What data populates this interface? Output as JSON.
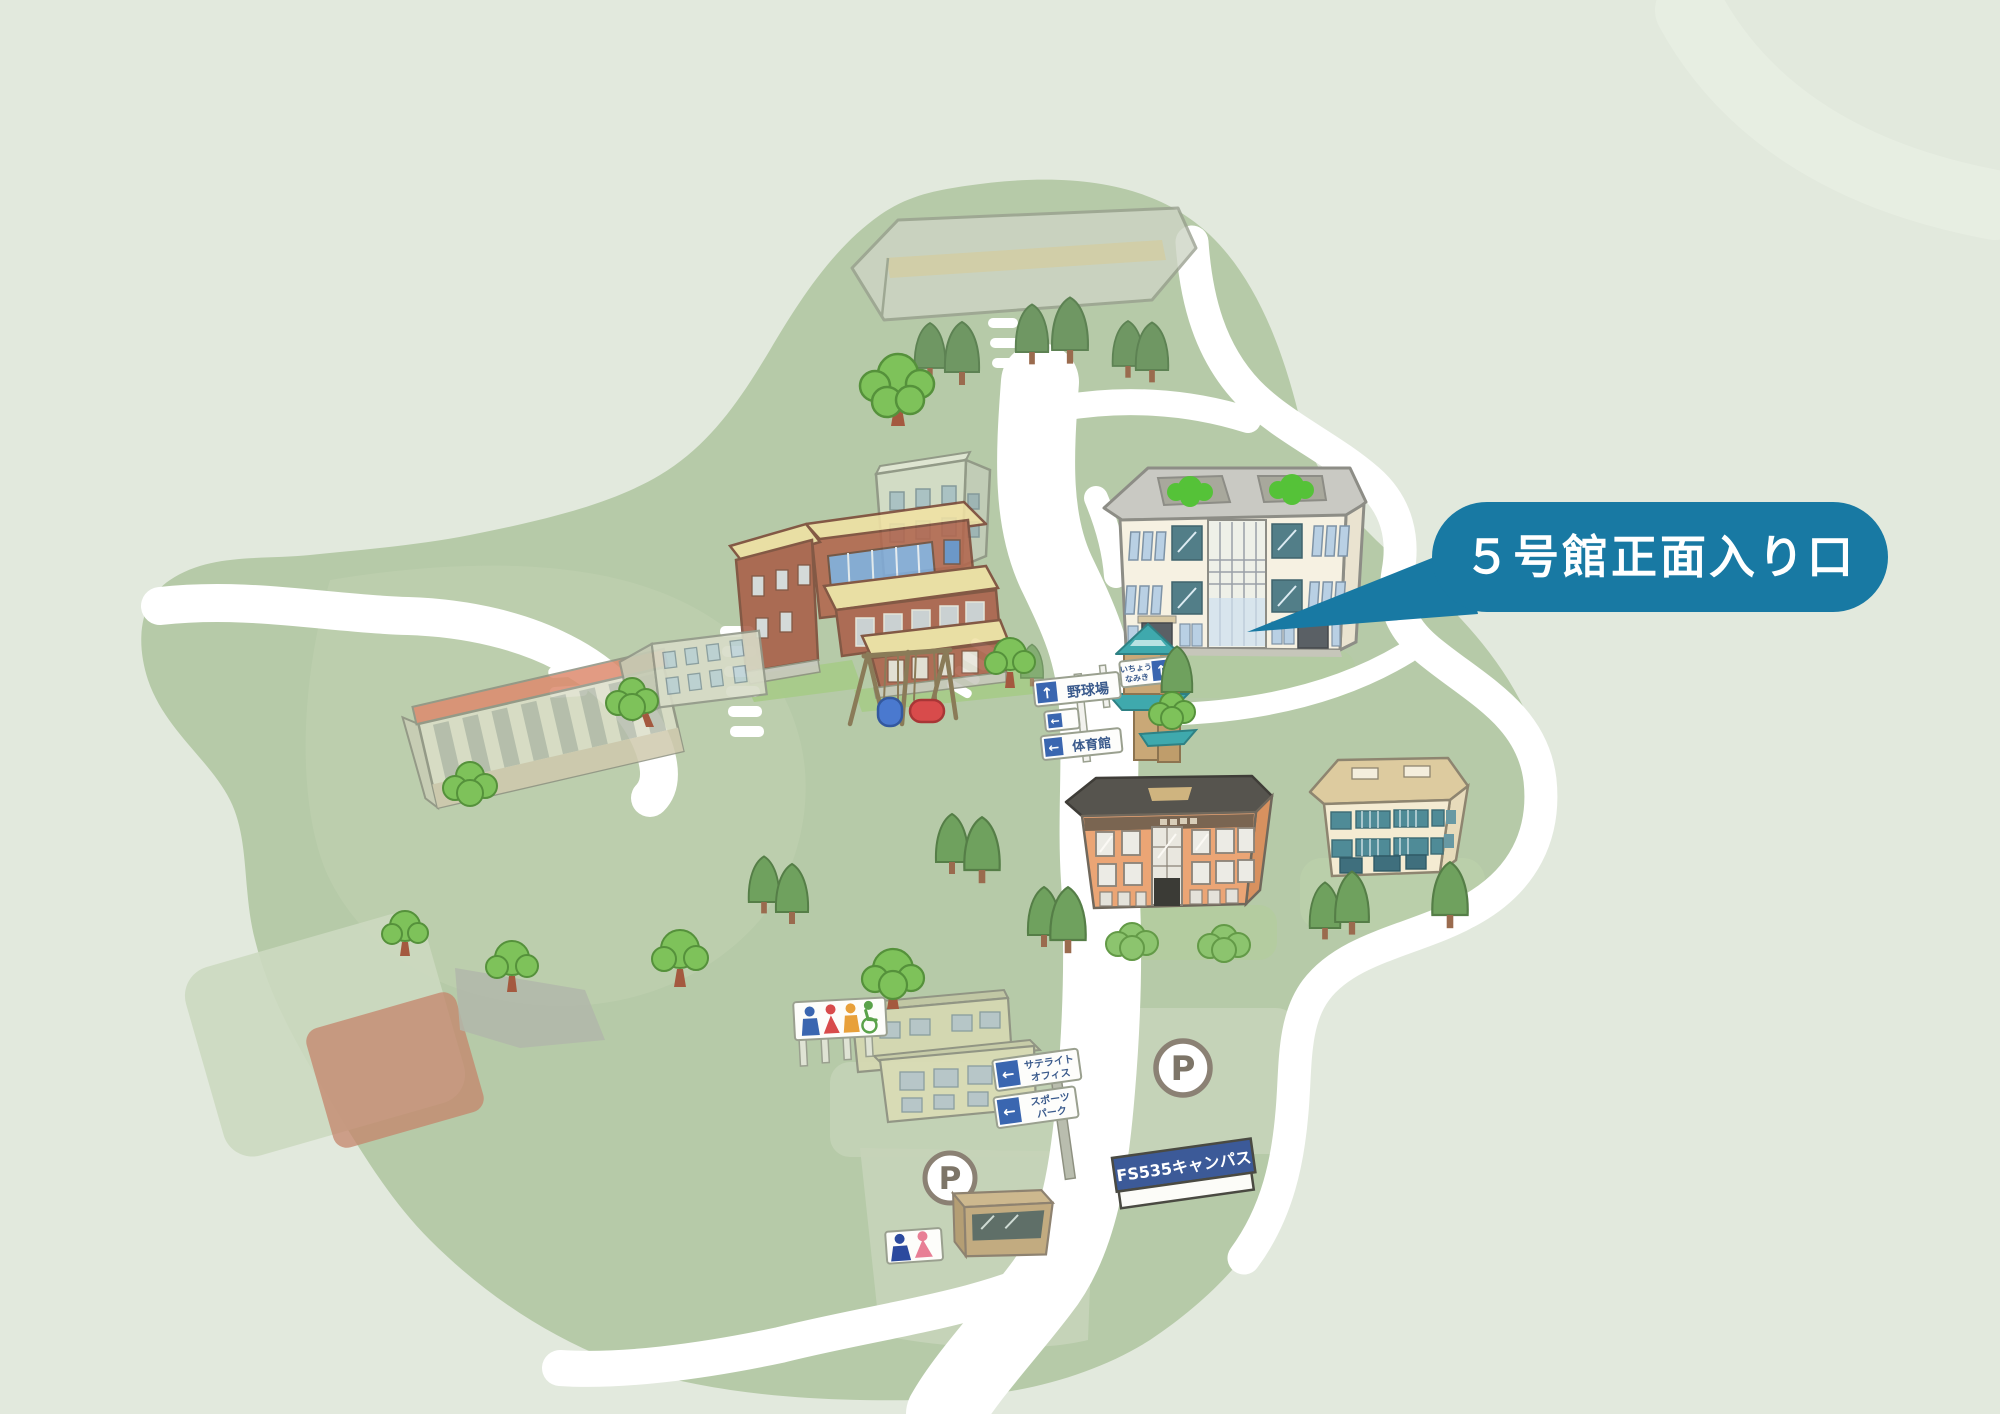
{
  "canvas": {
    "width": 2000,
    "height": 1414
  },
  "palette": {
    "background": "#e2e9dd",
    "campus_green": "#b6caa8",
    "road_white": "#ffffff",
    "callout_teal": "#1879a3",
    "banner_navy": "#3c5a98",
    "sign_blue": "#3a66b0",
    "lawn_green": "#a6cb87",
    "tree_green": "#7ec25a"
  },
  "callout": {
    "text": "５号館正面入り口",
    "bg": "#1879a3",
    "text_color": "#ffffff"
  },
  "signpost": {
    "signs": [
      {
        "arrow": "↑",
        "label": "野球場"
      },
      {
        "arrow": "↑",
        "lines": [
          "いちょう",
          "なみき"
        ]
      },
      {
        "arrow": "←",
        "label": ""
      },
      {
        "arrow": "←",
        "label": "体育館"
      }
    ]
  },
  "guide_signs": [
    {
      "arrow": "←",
      "lines": [
        "サテライト",
        "オフィス"
      ]
    },
    {
      "arrow": "←",
      "lines": [
        "スポーツ",
        "パーク"
      ]
    }
  ],
  "banner": {
    "text": "FS535キャンパス"
  },
  "parking": {
    "label": "P"
  },
  "icons": {
    "arrow_up": "↑",
    "arrow_left": "←",
    "parking": "P"
  }
}
